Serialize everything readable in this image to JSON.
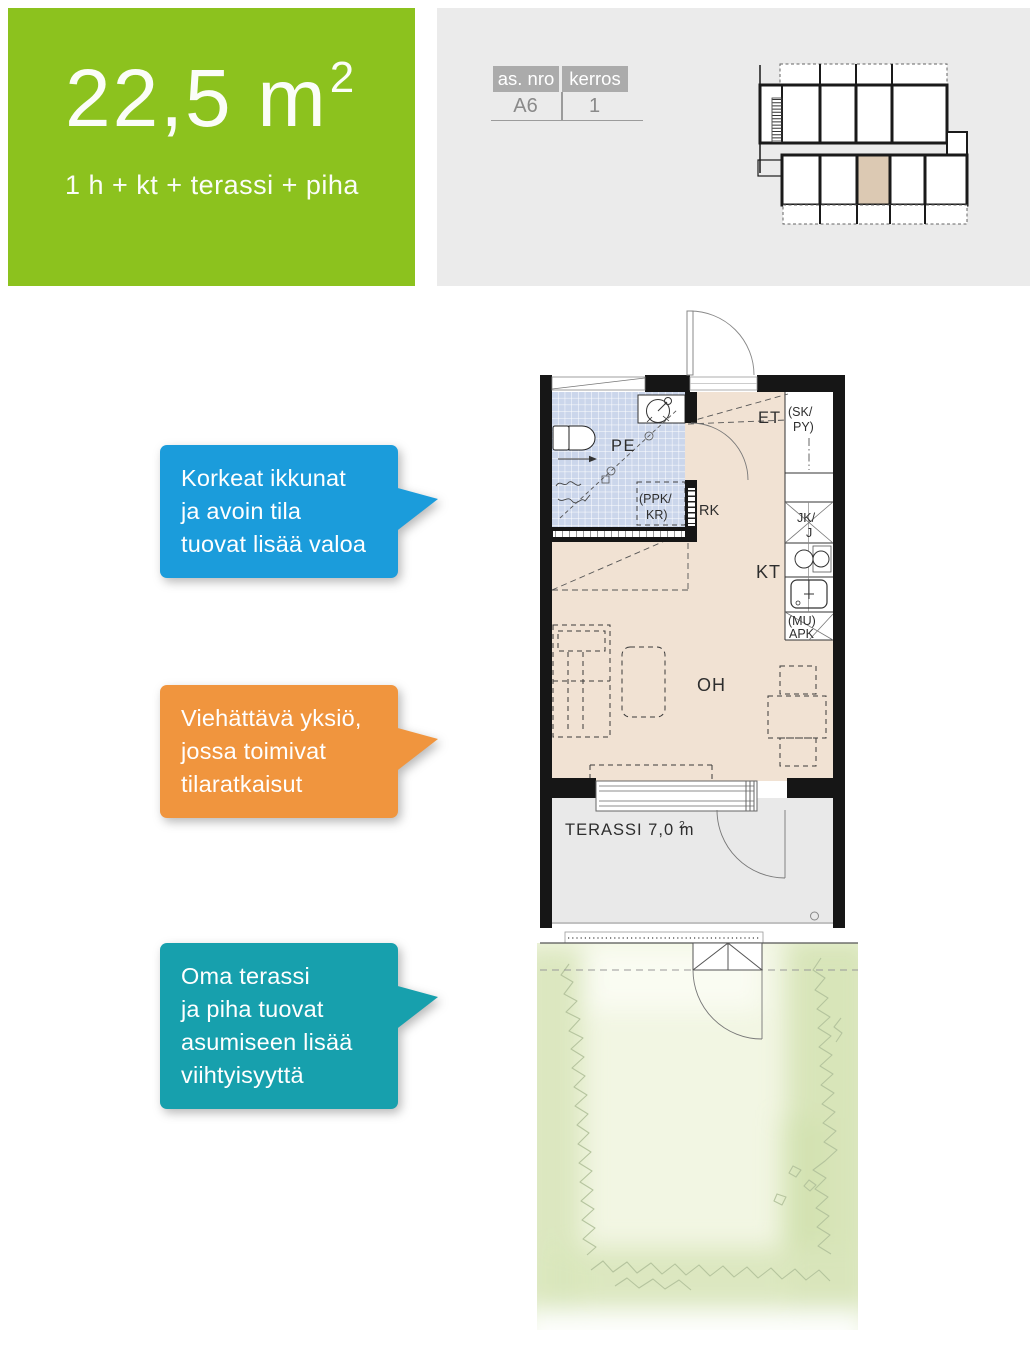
{
  "header": {
    "area": "22,5 m",
    "area_sup": "2",
    "rooms": "1 h + kt + terassi + piha",
    "accent_green": "#8CC21E"
  },
  "info_table": {
    "col1_header": "as. nro",
    "col2_header": "kerros",
    "col1_value": "A6",
    "col2_value": "1",
    "panel_color": "#EBEBEB",
    "header_color": "#ABABAB"
  },
  "locator": {
    "highlight_color": "#DCC9B3"
  },
  "callouts": {
    "blue": {
      "color": "#1B9CDB",
      "lines": [
        "Korkeat ikkunat",
        "ja avoin tila",
        "tuovat lisää valoa"
      ]
    },
    "orange": {
      "color": "#F0953E",
      "lines": [
        "Viehättävä yksiö,",
        "jossa toimivat",
        "tilaratkaisut"
      ]
    },
    "teal": {
      "color": "#17A0AD",
      "lines": [
        "Oma terassi",
        "ja piha tuovat",
        "asumiseen lisää",
        "viihtyisyyttä"
      ]
    }
  },
  "floorplan": {
    "labels": {
      "bathroom": "PE",
      "entry": "ET",
      "kitchen": "KT",
      "living": "OH",
      "electrical": "RK",
      "terrace": "TERASSI 7,0 m",
      "terrace_sup": "2",
      "closet_l1": "(SK/",
      "closet_l2": "PY)",
      "washer_l1": "(PPK/",
      "washer_l2": "KR)",
      "fridge_l1": "JK/",
      "fridge_l2": "J",
      "dishwasher_l1": "(MU)",
      "dishwasher_l2": "APK"
    },
    "colors": {
      "wall": "#161616",
      "floor": "#F1E2D3",
      "tile": "#CBD6EB",
      "terrace_floor": "#E9E9E9",
      "garden_light": "#F2F6E3",
      "garden_dark": "#D9E6BB"
    }
  }
}
